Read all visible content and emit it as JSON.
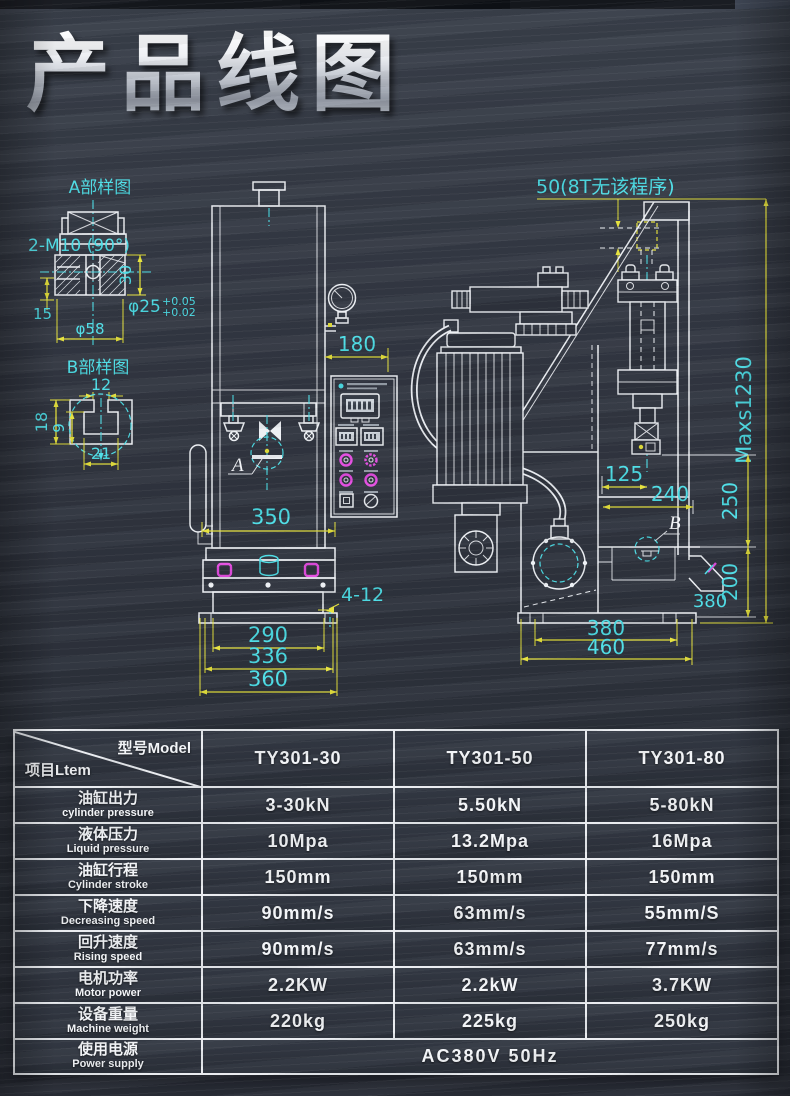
{
  "page": {
    "title": "产品线图"
  },
  "colors": {
    "background": "#2f343e",
    "line_white": "#edf0f4",
    "dim_yellow": "#e6e23c",
    "dim_text_cyan": "#4ddde6",
    "accent_magenta": "#e34de0",
    "table_border": "#e9ecf0"
  },
  "drawing": {
    "detail_a": {
      "label": "A部样图",
      "thread_note": "2-M10 (90°)",
      "dim_30": "30",
      "dim_15": "15",
      "dim_dia58": "φ58",
      "dim_dia25": "φ25",
      "tol_upper": "+0.05",
      "tol_lower": "+0.02"
    },
    "detail_b": {
      "label": "B部样图",
      "dim_12": "12",
      "dim_18": "18",
      "dim_9": "9",
      "dim_21": "21"
    },
    "front_view": {
      "marker": "A",
      "dim_180": "180",
      "dim_350": "350",
      "holes_note": "4-12",
      "dim_290": "290",
      "dim_336": "336",
      "dim_360": "360"
    },
    "side_view": {
      "marker": "B",
      "stroke_note": "50(8T无该程序)",
      "dim_max_height": "Maxs1230",
      "dim_125": "125",
      "dim_240": "240",
      "dim_250": "250",
      "dim_200": "200",
      "dim_380_right": "380",
      "dim_380_bottom": "380",
      "dim_460": "460"
    }
  },
  "spec_table": {
    "corner": {
      "model_label": "型号Model",
      "item_label": "项目Ltem"
    },
    "models": [
      "TY301-30",
      "TY301-50",
      "TY301-80"
    ],
    "rows": [
      {
        "cn": "油缸出力",
        "en": "cylinder pressure",
        "values": [
          "3-30kN",
          "5.50kN",
          "5-80kN"
        ]
      },
      {
        "cn": "液体压力",
        "en": "Liquid pressure",
        "values": [
          "10Mpa",
          "13.2Mpa",
          "16Mpa"
        ]
      },
      {
        "cn": "油缸行程",
        "en": "Cylinder stroke",
        "values": [
          "150mm",
          "150mm",
          "150mm"
        ]
      },
      {
        "cn": "下降速度",
        "en": "Decreasing speed",
        "values": [
          "90mm/s",
          "63mm/s",
          "55mm/S"
        ]
      },
      {
        "cn": "回升速度",
        "en": "Rising speed",
        "values": [
          "90mm/s",
          "63mm/s",
          "77mm/s"
        ]
      },
      {
        "cn": "电机功率",
        "en": "Motor power",
        "values": [
          "2.2KW",
          "2.2kW",
          "3.7KW"
        ]
      },
      {
        "cn": "设备重量",
        "en": "Machine weight",
        "values": [
          "220kg",
          "225kg",
          "250kg"
        ]
      }
    ],
    "power_row": {
      "cn": "使用电源",
      "en": "Power supply",
      "value": "AC380V 50Hz"
    }
  }
}
